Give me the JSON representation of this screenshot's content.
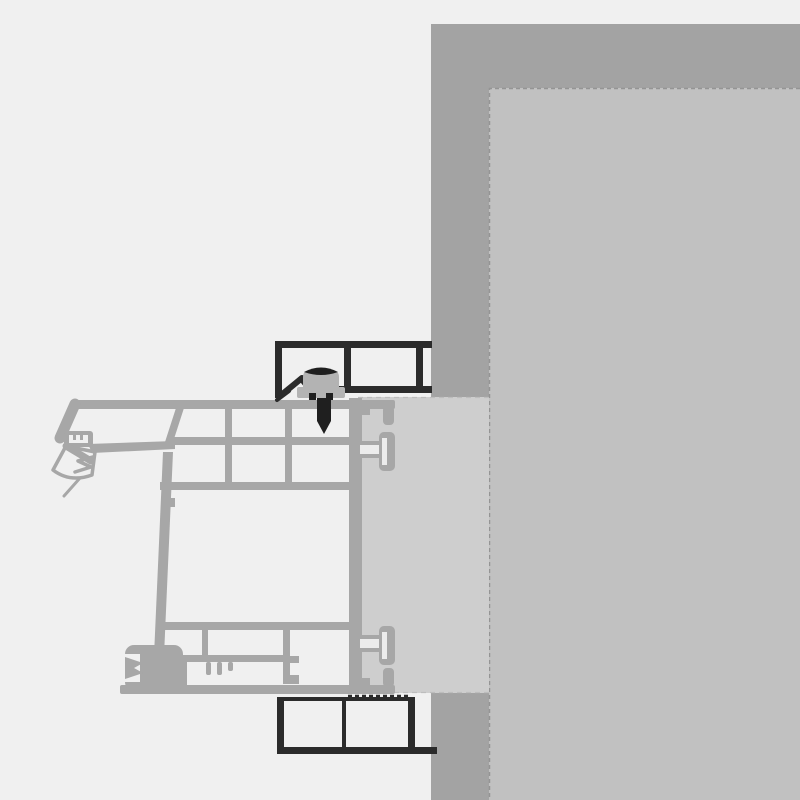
{
  "canvas": {
    "width": 800,
    "height": 800
  },
  "colors": {
    "c-bg": "#f0f0f0",
    "c-wall": "#a3a3a3",
    "c-reveal": "#c1c1c1",
    "c-ext": "#cecece",
    "c-frame": "#a7a7a7",
    "c-cell": "#f0f0f0",
    "c-trim": "#2b2b2b",
    "c-screw": "#b3b3b3",
    "c-screwdark": "#1f1f1f",
    "c-edge": "#949494",
    "c-light2": "#ececec",
    "c-extedge": "#bdbdbd"
  },
  "components": {
    "wall-band": "wall-section",
    "interior-reveal": "interior-reveal-surface",
    "frame-extension-block": "packing-block",
    "window-frame-profile": "multi-chamber-frame-cross-section",
    "glazing-gasket-wing": "exterior-gasket",
    "hardware-groove": "hardware-channel",
    "anchor-connectors": "snap-anchors",
    "exterior-trim-top": "top-trim-profile",
    "exterior-trim-bottom": "bottom-trim-profile",
    "fixing-screw": "frame-fixing-screw"
  }
}
